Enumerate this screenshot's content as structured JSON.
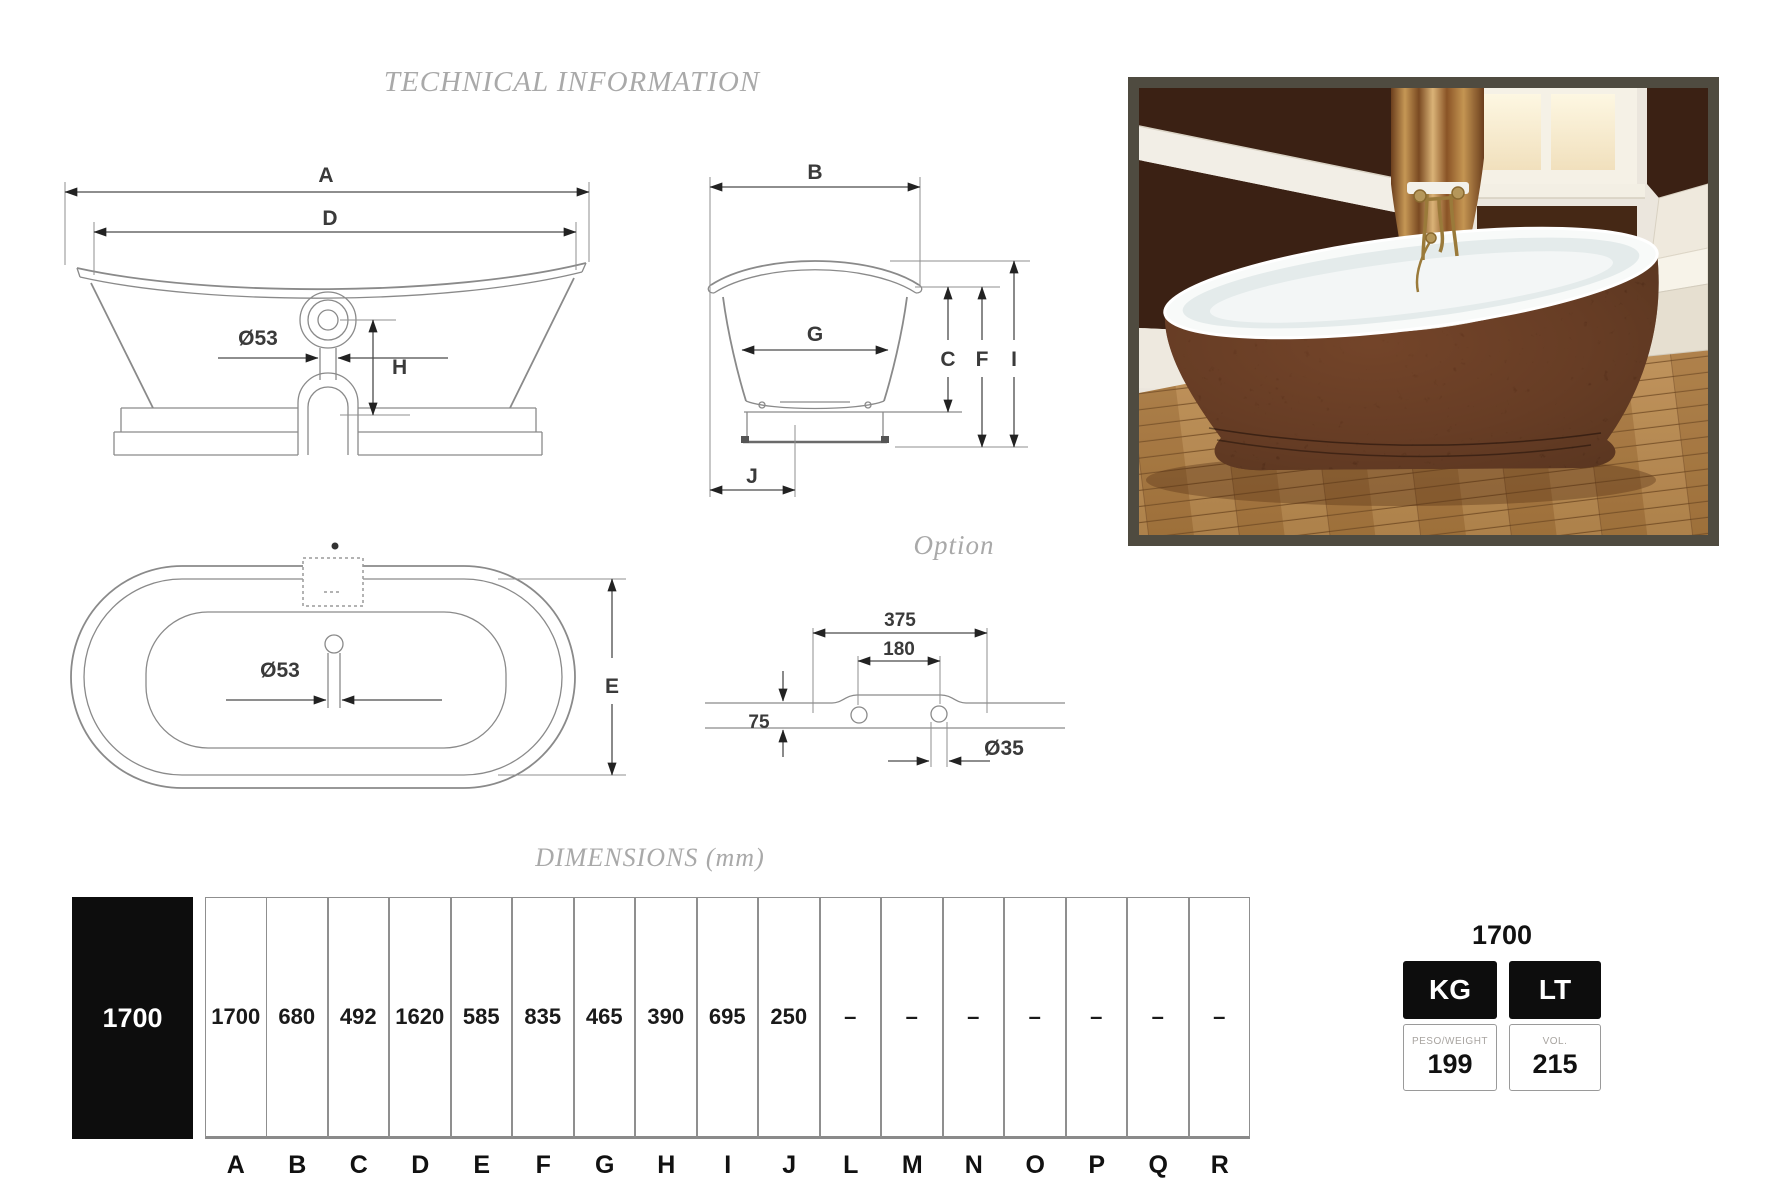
{
  "page": {
    "title": "TECHNICAL INFORMATION",
    "dimensions_title": "DIMENSIONS (mm)",
    "option_label": "Option"
  },
  "drawings": {
    "front_view": {
      "dim_a": "A",
      "dim_d": "D",
      "drain_diameter": "Ø53",
      "dim_h": "H"
    },
    "side_view": {
      "dim_b": "B",
      "dim_g": "G",
      "dim_c": "C",
      "dim_f": "F",
      "dim_i": "I",
      "dim_j": "J"
    },
    "top_view": {
      "drain_diameter": "Ø53",
      "dim_e": "E"
    },
    "option_detail": {
      "width_outer": "375",
      "width_inner": "180",
      "height": "75",
      "hole_diameter": "Ø35"
    }
  },
  "dimensions_table": {
    "row_label": "1700",
    "columns": [
      {
        "letter": "A",
        "value": "1700"
      },
      {
        "letter": "B",
        "value": "680"
      },
      {
        "letter": "C",
        "value": "492"
      },
      {
        "letter": "D",
        "value": "1620"
      },
      {
        "letter": "E",
        "value": "585"
      },
      {
        "letter": "F",
        "value": "835"
      },
      {
        "letter": "G",
        "value": "465"
      },
      {
        "letter": "H",
        "value": "390"
      },
      {
        "letter": "I",
        "value": "695"
      },
      {
        "letter": "J",
        "value": "250"
      },
      {
        "letter": "L",
        "value": "–"
      },
      {
        "letter": "M",
        "value": "–"
      },
      {
        "letter": "N",
        "value": "–"
      },
      {
        "letter": "O",
        "value": "–"
      },
      {
        "letter": "P",
        "value": "–"
      },
      {
        "letter": "Q",
        "value": "–"
      },
      {
        "letter": "R",
        "value": "–"
      }
    ]
  },
  "spec_panel": {
    "size": "1700",
    "weight_unit": "KG",
    "volume_unit": "LT",
    "weight_label": "PESO/WEIGHT",
    "weight_value": "199",
    "volume_label": "VOL.",
    "volume_value": "215"
  },
  "colors": {
    "caption_gray": "#a9a9a9",
    "table_black": "#0d0d0d",
    "line_gray": "#8a8a8a",
    "photo_frame": "#4f4b40",
    "tub_brown": "#4a2212"
  }
}
